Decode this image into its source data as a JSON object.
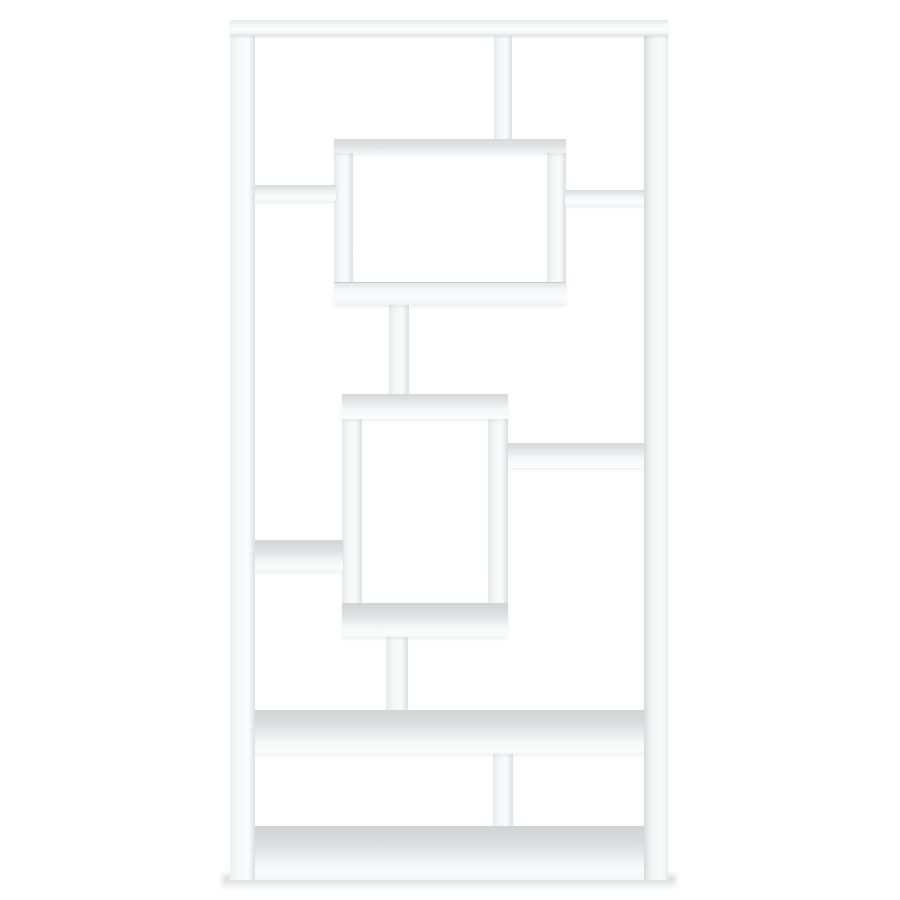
{
  "scene": {
    "type": "product-photo",
    "subject": "White geometric 10-shelf etagere bookcase with interlocking rectangular compartments, centered on a seamless white studio background",
    "background_color": "#ffffff",
    "furniture_face_color": "#fafbfb",
    "surface_shading_color": "#d6d8da",
    "edge_shading_color": "#cdd0d2",
    "floor_shadow_color": "#787e83"
  },
  "theme": {
    "css_vars": "--bg:#ffffff; --face:#fafbfb; --surface:#d6d8da; --edge:#cdd0d2"
  },
  "bookcase": {
    "parts": {
      "floor_shadow": {
        "label": "soft floor shadow under base",
        "style": "left:222px;top:872px;width:454px;height:18px"
      },
      "bottom_divider": {
        "label": "bottom compartment divider",
        "style": "left:493px;top:752px;width:20px;height:80px"
      },
      "base": {
        "label": "bottom base shelf",
        "style": "left:230px;top:826px;width:438px;height:54px"
      },
      "lower_connector": {
        "label": "vertical connector below center box",
        "style": "left:386px;top:637px;width:22px;height:74px"
      },
      "wide_shelf": {
        "label": "full-width lower shelf",
        "style": "left:254px;top:710px;width:392px;height:44px"
      },
      "top_divider": {
        "label": "upper compartment divider",
        "style": "left:494px;top:36px;width:18px;height:104px"
      },
      "upper_connector": {
        "label": "vertical connector between boxes",
        "style": "left:389px;top:304px;width:20px;height:92px"
      },
      "box1_left_wall": {
        "label": "upper box left wall",
        "style": "left:334px;top:139px;width:19px;height:165px"
      },
      "box1_right_wall": {
        "label": "upper box right wall",
        "style": "left:547px;top:139px;width:19px;height:165px"
      },
      "box1_top": {
        "label": "upper box top panel",
        "style": "left:334px;top:139px;width:232px;height:14px"
      },
      "box1_bottom": {
        "label": "upper box bottom panel",
        "style": "left:334px;top:282px;width:232px;height:22px"
      },
      "box2_left_wall": {
        "label": "center box left wall",
        "style": "left:342px;top:395px;width:20px;height:242px"
      },
      "box2_right_wall": {
        "label": "center box right wall",
        "style": "left:488px;top:395px;width:20px;height:242px"
      },
      "box2_top": {
        "label": "center box top panel",
        "style": "left:342px;top:394px;width:166px;height:25px"
      },
      "box2_bottom": {
        "label": "center box bottom panel",
        "style": "left:342px;top:603px;width:166px;height:34px"
      },
      "upper_left_shelf": {
        "label": "upper left side shelf",
        "style": "left:254px;top:185px;width:82px;height:16px"
      },
      "upper_right_shelf": {
        "label": "upper right side shelf",
        "style": "left:565px;top:190px;width:81px;height:15px"
      },
      "middle_right_shelf": {
        "label": "middle right side shelf",
        "style": "left:508px;top:443px;width:138px;height:25px"
      },
      "middle_left_shelf": {
        "label": "middle left side shelf",
        "style": "left:254px;top:540px;width:89px;height:31px"
      },
      "left_post": {
        "label": "left side post",
        "style": "left:230px;top:20px;width:25px;height:860px"
      },
      "right_post": {
        "label": "right side post",
        "style": "left:644px;top:20px;width:24px;height:860px"
      },
      "top_bar": {
        "label": "top panel",
        "style": "left:230px;top:20px;width:438px;height:16px"
      }
    }
  }
}
